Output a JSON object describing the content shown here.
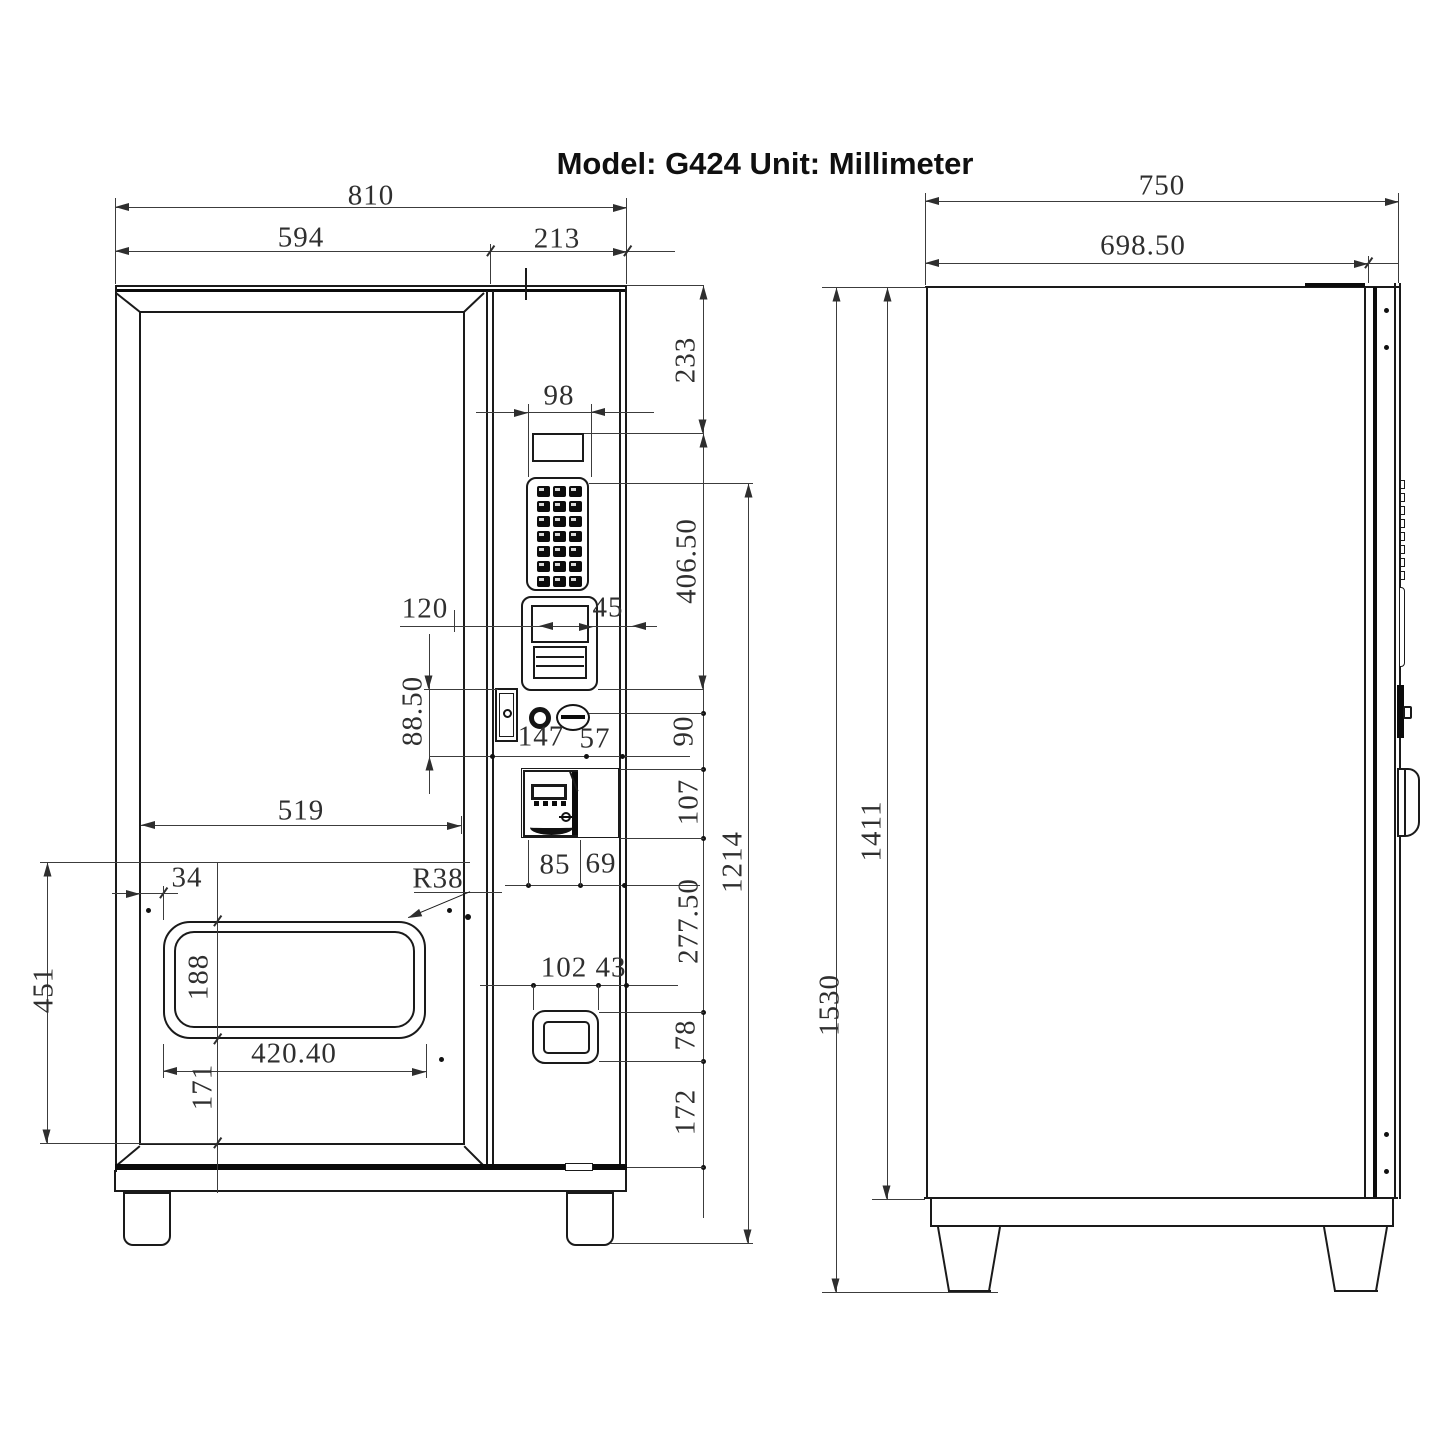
{
  "title": {
    "text": "Model: G424 Unit: Millimeter",
    "model": "G424",
    "unit": "Millimeter"
  },
  "views": {
    "front": "front elevation of vending machine cabinet",
    "side": "right side elevation of vending machine cabinet"
  },
  "dims": {
    "front": {
      "overall_width": "810",
      "door_width": "594",
      "control_panel_width": "213",
      "keypad_width": "98",
      "top_to_display": "233",
      "display_to_bill_acceptor": "406.50",
      "bill_left_offset": "120",
      "bill_slot_width": "45",
      "lock_height": "88.50",
      "coin_slot_offset": "147",
      "coin_slot_to_edge": "57",
      "coin_slot_to_coin_mech": "90",
      "coin_mech_height": "107",
      "window_width": "519",
      "coin_mech_width": "85",
      "coin_mech_to_edge": "69",
      "keypad_to_ground": "1214",
      "coin_mech_to_pickup": "277.50",
      "pickup_left_offset": "34",
      "pickup_corner_radius": "R38",
      "lower_door_height": "451",
      "pickup_height": "188",
      "pickup_width": "420.40",
      "pickup_to_bottom": "171",
      "outlet_left_offset": "102",
      "outlet_to_edge": "43",
      "outlet_height": "78",
      "outlet_to_bottom": "172"
    },
    "side": {
      "overall_depth": "750",
      "body_depth": "698.50",
      "overall_height": "1530",
      "body_height": "1411"
    }
  }
}
